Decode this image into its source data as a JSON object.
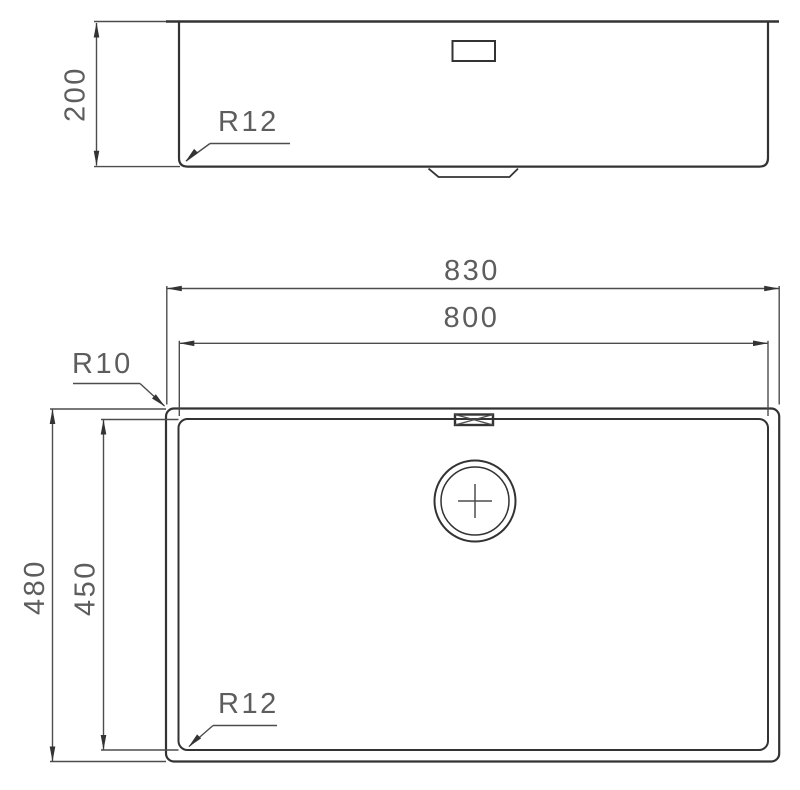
{
  "drawing": {
    "kind": "sink technical drawing, side elevation above plan view",
    "colors": {
      "background": "#ffffff",
      "object_line": "#333333",
      "dimension_line": "#4d4d4d",
      "label_text": "#5d5d5d"
    },
    "labels": {
      "side_height": "200",
      "side_corner_radius": "R12",
      "plan_outer_width": "830",
      "plan_inner_width": "800",
      "plan_outer_height": "480",
      "plan_inner_height": "450",
      "plan_outer_corner_radius": "R10",
      "plan_inner_corner_radius": "R12"
    }
  }
}
